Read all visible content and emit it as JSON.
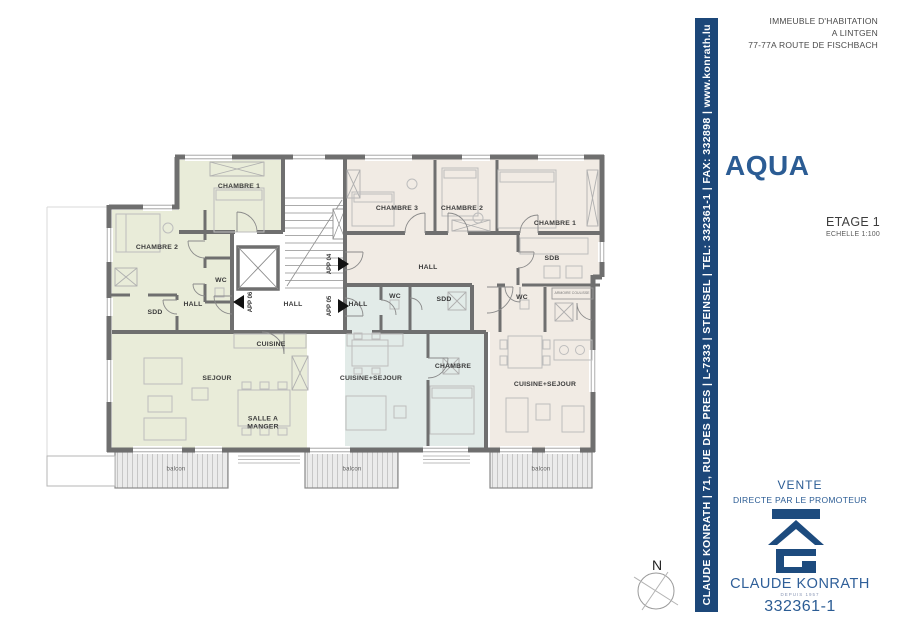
{
  "header": {
    "address_lines": [
      "IMMEUBLE D'HABITATION",
      "A LINTGEN",
      "77-77A ROUTE DE FISCHBACH"
    ]
  },
  "side_banner": {
    "text": "CLAUDE KONRATH | 71, RUE DES PRES | L-7333 | STEINSEL | TEL: 332361-1 | FAX: 332898 | www.konrath.lu"
  },
  "project": {
    "name": "AQUA",
    "floor": "ETAGE 1",
    "scale": "ECHELLE 1:100"
  },
  "sale": {
    "title": "VENTE",
    "subtitle": "DIRECTE PAR LE PROMOTEUR",
    "company": "CLAUDE KONRATH",
    "since": "DEPUIS 1957",
    "reference": "332361-1"
  },
  "compass": {
    "north_label": "N"
  },
  "colors": {
    "banner_blue": "#1c4779",
    "brand_blue": "#2b5c94",
    "apt_06_green": "#e9ecd9",
    "apt_05_blue": "#e2ebe8",
    "apt_04_beige": "#f1ebe4",
    "wall_gray": "#6f6f6f"
  },
  "plan": {
    "core": {
      "hall_label": "HALL"
    },
    "units": [
      {
        "door_label": "APP 06",
        "rooms": [
          "CHAMBRE 1",
          "CHAMBRE 2",
          "WC",
          "SDD",
          "HALL",
          "CUISINE",
          "SEJOUR",
          "SALLE A MANGER",
          "balcon"
        ]
      },
      {
        "door_label": "APP 05",
        "rooms": [
          "HALL",
          "WC",
          "SDD",
          "CUISINE+SEJOUR",
          "CHAMBRE",
          "balcon"
        ]
      },
      {
        "door_label": "APP 04",
        "rooms": [
          "CHAMBRE 3",
          "CHAMBRE 2",
          "CHAMBRE 1",
          "SDB",
          "HALL",
          "WC",
          "ARMOIRE COULISSE",
          "CUISINE+SEJOUR",
          "balcon"
        ]
      }
    ]
  }
}
